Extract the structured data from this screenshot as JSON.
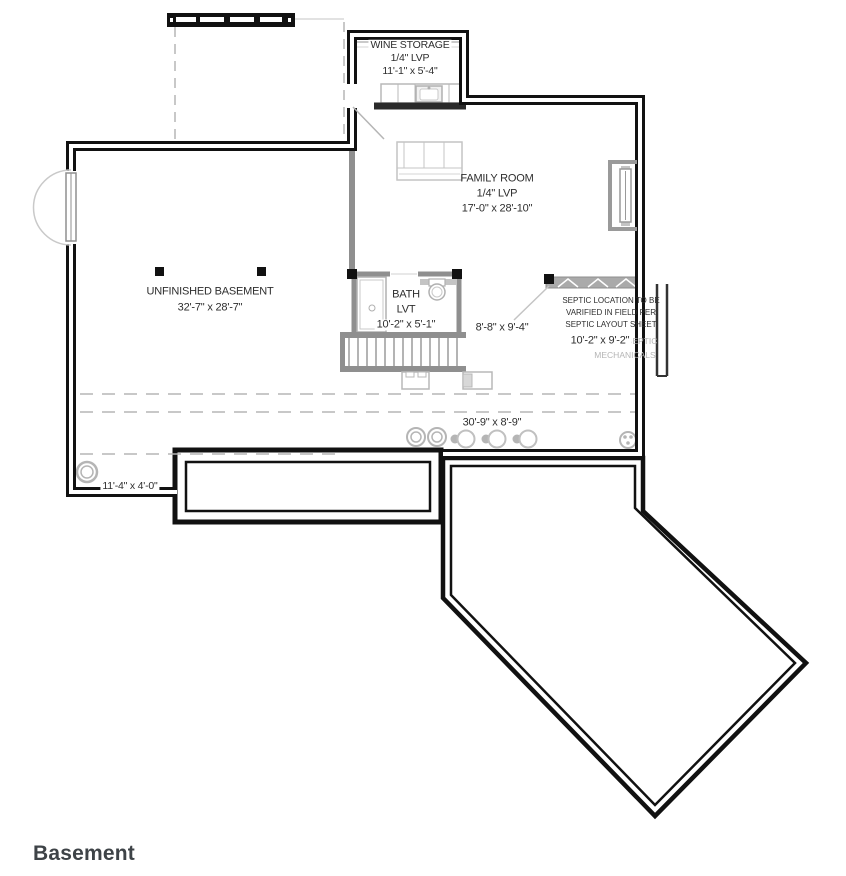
{
  "plan": {
    "title": "Basement",
    "rooms": {
      "wine_storage": {
        "name": "WINE STORAGE",
        "floor": "1/4\" LVP",
        "dims": "11'-1\" x 5'-4\""
      },
      "family_room": {
        "name": "FAMILY ROOM",
        "floor": "1/4\" LVP",
        "dims": "17'-0\" x 28'-10\""
      },
      "unfinished_basement": {
        "name": "UNFINISHED BASEMENT",
        "dims": "32'-7\" x 28'-7\""
      },
      "bath": {
        "name": "BATH",
        "floor": "LVT",
        "dims": "10'-2\" x 5'-1\""
      },
      "stair_area": {
        "dims": "8'-8\" x 9'-4\""
      },
      "septic_mechanicals": {
        "name_line1": "SEPTIC",
        "name_line2": "MECHANICALS",
        "dims": "10'-2\" x 9'-2\""
      },
      "utility_span": {
        "dims": "30'-9\" x 8'-9\""
      },
      "sump_area": {
        "dims": "11'-4\" x 4'-0\""
      }
    },
    "notes": {
      "septic": {
        "line1": "SEPTIC LOCATION TO BE",
        "line2": "VARIFIED IN FIELD PER",
        "line3": "SEPTIC LAYOUT SHEET"
      }
    },
    "colors": {
      "wall": "#111111",
      "interior_wall": "#8f8f8f",
      "fixture": "#b8b8b8",
      "dashed": "#b5b5b5",
      "text": "#2e2e2e",
      "muted_text": "#b5b5b5",
      "title_text": "#3e4347"
    }
  }
}
